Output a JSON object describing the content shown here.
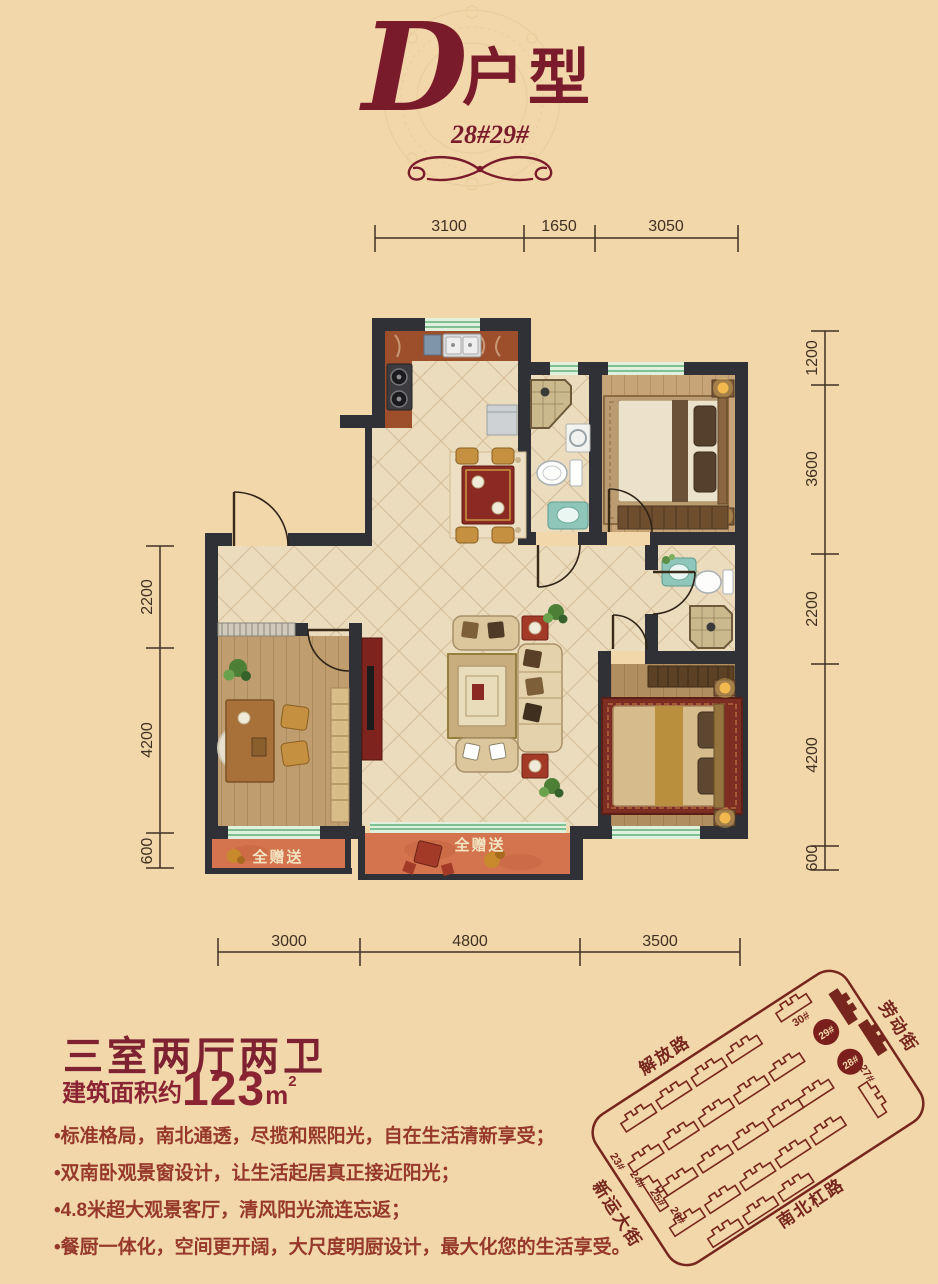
{
  "page": {
    "bg": "#f2d7ab",
    "accent": "#7a1b2b"
  },
  "header": {
    "letter": "D",
    "suffix": "户型",
    "subtitle": "28#29#"
  },
  "plan": {
    "gift_left": "全赠送",
    "gift_center": "全赠送",
    "dims": {
      "top": [
        "3100",
        "1650",
        "3050"
      ],
      "bottom": [
        "3000",
        "4800",
        "3500"
      ],
      "left": [
        "2200",
        "4200",
        "600"
      ],
      "right": [
        "1200",
        "3600",
        "2200",
        "4200",
        "600"
      ]
    }
  },
  "summary": {
    "title": "三室两厅两卫",
    "area_prefix": "建筑面积约",
    "area_value": "123",
    "area_unit": "m",
    "area_sup": "2"
  },
  "features": [
    "•标准格局，南北通透，尽揽和熙阳光，自在生活清新享受；",
    "•双南卧观景窗设计，让生活起居真正接近阳光；",
    "•4.8米超大观景客厅，清风阳光流连忘返；",
    "•餐厨一体化，空间更开阔，大尺度明厨设计，最大化您的生活享受。"
  ],
  "sitemap": {
    "streets": {
      "jiefanglu": "解放路",
      "laodongjie": "劳动街",
      "xinyundajie": "新运大街",
      "nanbeiganglu": "南北杠路"
    },
    "buildings": {
      "b23": "23#",
      "b24": "24#",
      "b25": "25#",
      "b26": "26#",
      "b27": "27#",
      "b28": "28#",
      "b29": "29#",
      "b30": "30#"
    }
  }
}
